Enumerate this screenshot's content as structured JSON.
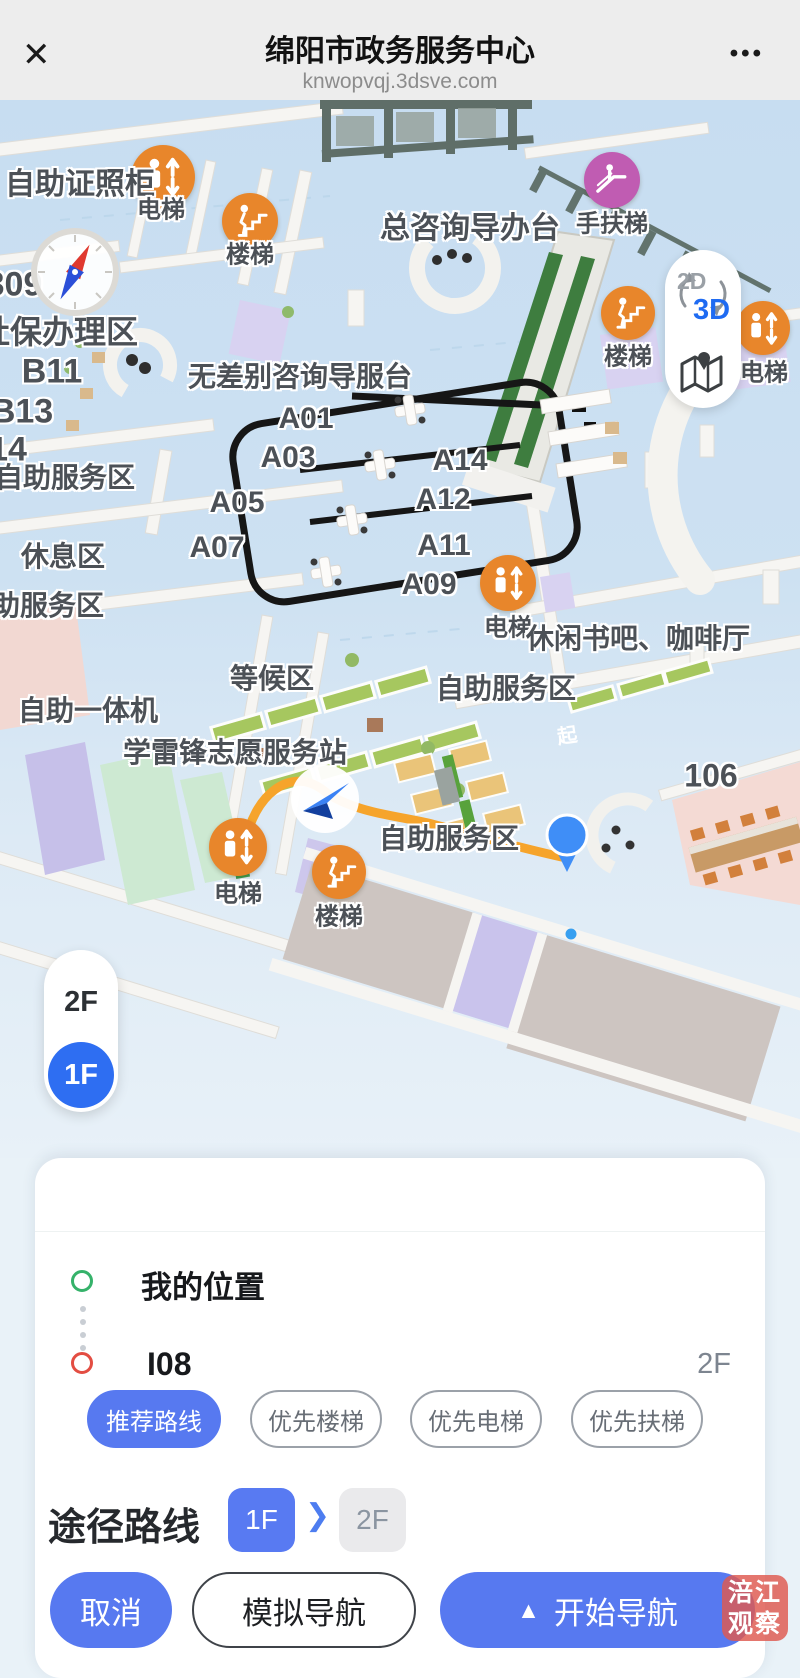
{
  "header": {
    "close_icon": "✕",
    "title": "绵阳市政务服务中心",
    "subtitle": "knwopvqj.3dsve.com",
    "menu_icon": "•••"
  },
  "map": {
    "view_toggle": {
      "label_2d": "2D",
      "label_3d": "3D"
    },
    "start_marker": "起",
    "floor_switcher": {
      "upper": "2F",
      "current": "1F"
    },
    "labels": [
      "自助证照柜",
      "电梯",
      "楼梯",
      "总咨询导办台",
      "手扶梯",
      "309",
      "社保办理区",
      "B11",
      "B13",
      "14",
      "无差别咨询导服台",
      "A01",
      "A03",
      "A05",
      "A07",
      "A14",
      "A12",
      "A11",
      "A09",
      "自助服务区",
      "休息区",
      "助服务区",
      "电梯",
      "休闲书吧、咖啡厅",
      "自助服务区",
      "等候区",
      "自助一体机",
      "学雷锋志愿服务站",
      "自助服务区",
      "106",
      "电梯",
      "楼梯",
      "楼梯",
      "电梯"
    ]
  },
  "panel": {
    "origin": {
      "label": "我的位置"
    },
    "destination": {
      "label": "I08",
      "floor": "2F"
    },
    "route_options": [
      "推荐路线",
      "优先楼梯",
      "优先电梯",
      "优先扶梯"
    ],
    "via": {
      "label": "途径路线",
      "floors": [
        "1F",
        "2F"
      ],
      "chevron": "❯"
    },
    "actions": {
      "cancel": "取消",
      "simulate": "模拟导航",
      "start": "开始导航",
      "start_icon": "▲"
    }
  },
  "watermark": {
    "line1": "涪江",
    "line2": "观察"
  }
}
